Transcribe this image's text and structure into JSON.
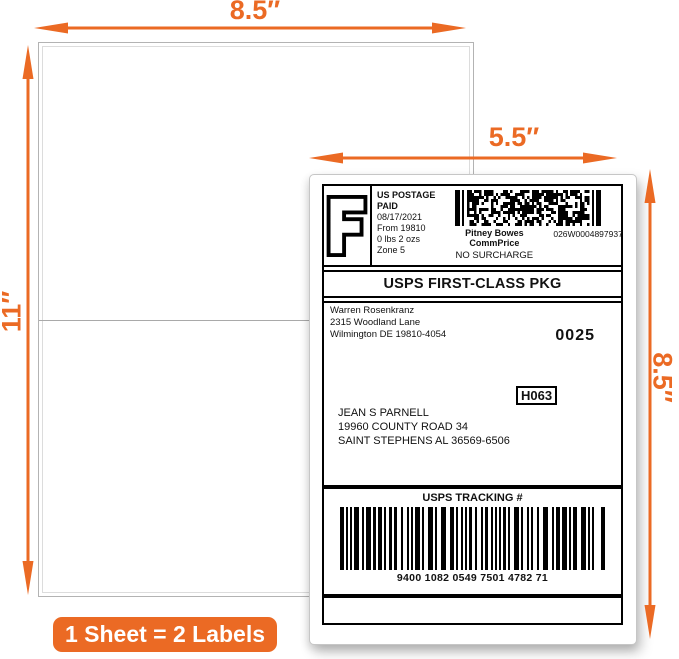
{
  "colors": {
    "accent": "#EB6A24"
  },
  "dimensions": {
    "sheet_width": "8.5″",
    "sheet_height": "11″",
    "label_width": "5.5″",
    "label_height": "8.5″"
  },
  "badge": {
    "text": "1 Sheet = 2 Labels"
  },
  "label": {
    "indicia_letter": "F",
    "postage": {
      "line1": "US POSTAGE",
      "line2": "PAID",
      "date": "08/17/2021",
      "origin": "From 19810",
      "weight": "0 lbs 2 ozs",
      "zone": "Zone 5"
    },
    "meter": {
      "carrier": "Pitney Bowes",
      "program": "CommPrice",
      "number": "026W0004897937",
      "surcharge": "NO SURCHARGE"
    },
    "service": "USPS FIRST-CLASS PKG",
    "sender": {
      "name": "Warren Rosenkranz",
      "street": "2315 Woodland Lane",
      "city_line": "Wilmington DE 19810-4054"
    },
    "batch": "0025",
    "routing": "H063",
    "recipient": {
      "name": "JEAN S PARNELL",
      "street": "19960 COUNTY ROAD 34",
      "city_line": "SAINT STEPHENS AL 36569-6506"
    },
    "tracking": {
      "title": "USPS TRACKING #",
      "number": "9400 1082 0549 7501 4782 71"
    }
  }
}
